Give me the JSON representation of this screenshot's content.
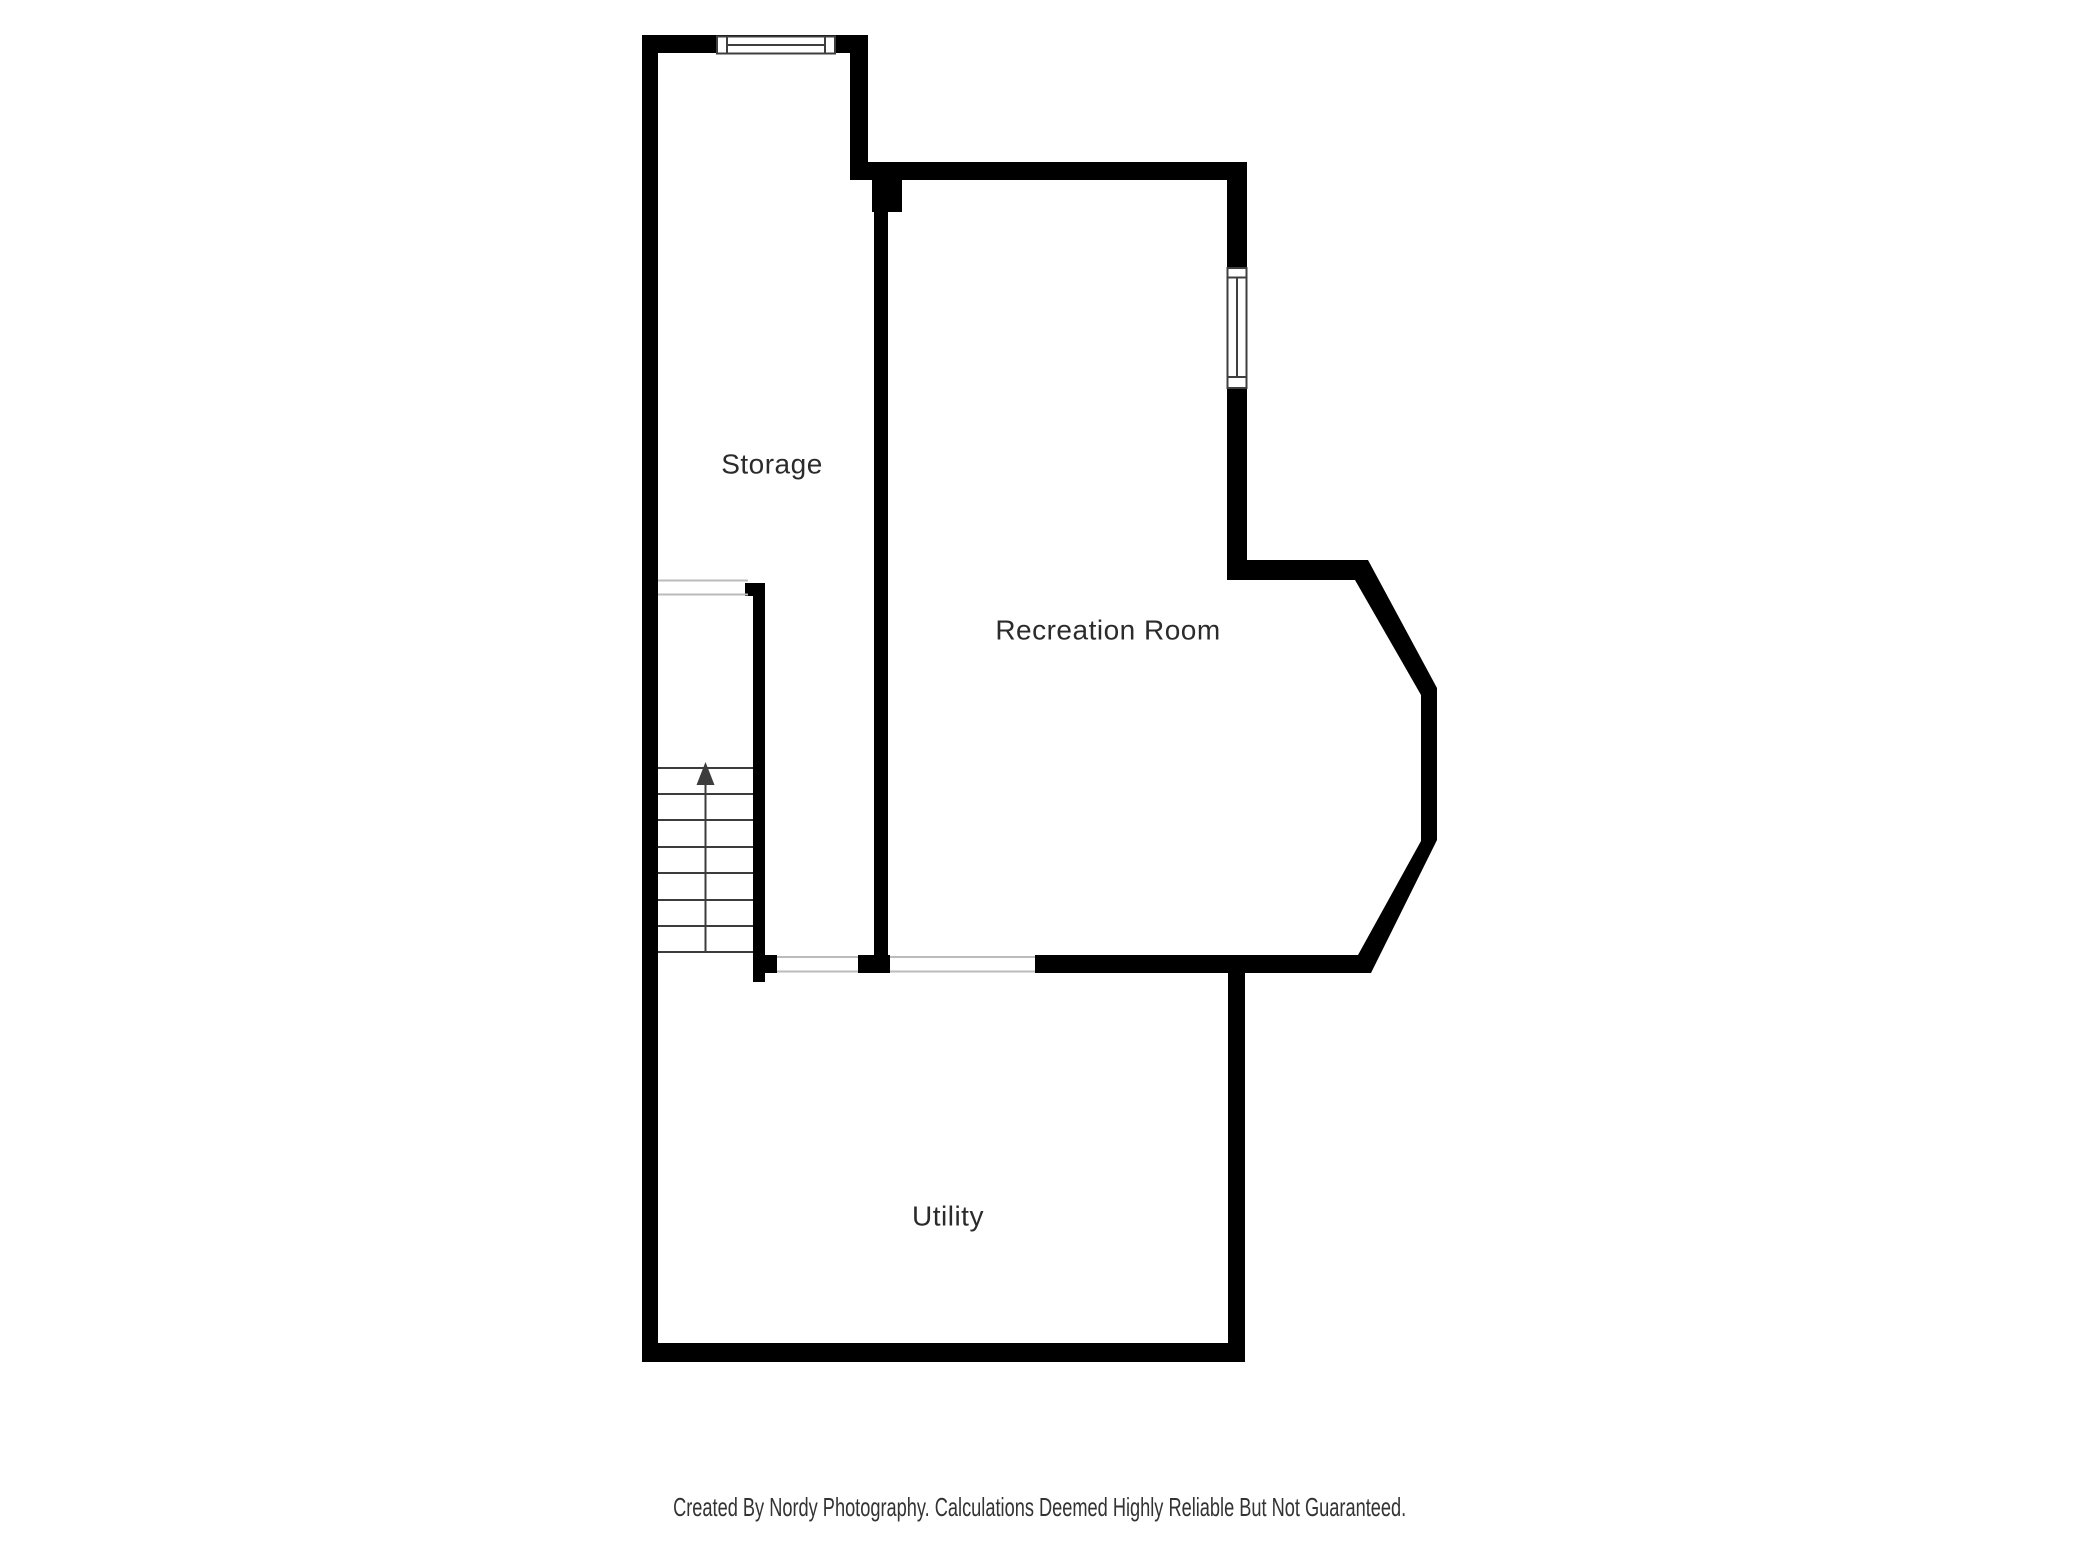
{
  "floor_plan": {
    "rooms": [
      {
        "label": "Storage"
      },
      {
        "label": "Recreation Room"
      },
      {
        "label": "Utility"
      }
    ],
    "stairs": {
      "tread_count": 8,
      "direction_arrow": "up"
    },
    "windows": [
      {
        "name": "storage-top-wall-window"
      },
      {
        "name": "recreation-right-wall-window"
      }
    ],
    "colors": {
      "wall": "#000000",
      "window_frame": "#3f3f3f",
      "opening_line": "#bbbbbb",
      "stair_line": "#3c3c3c",
      "label_text": "#2b2b2b",
      "background": "#ffffff"
    }
  },
  "footer": {
    "caption": "Created By Nordy Photography. Calculations Deemed Highly Reliable But Not Guaranteed."
  }
}
